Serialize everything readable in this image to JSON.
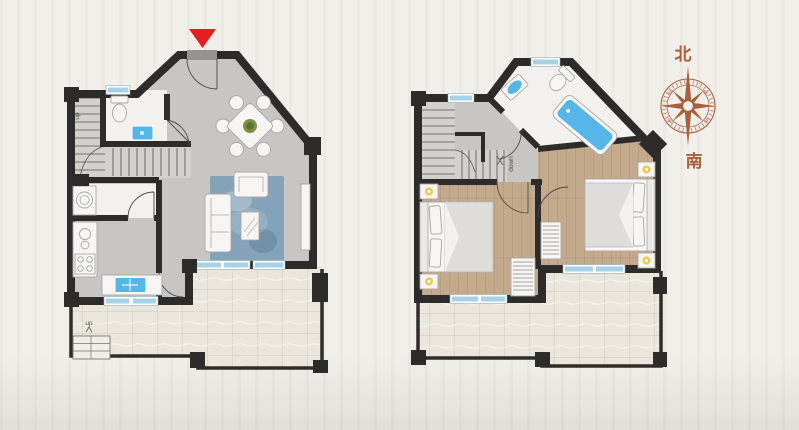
{
  "scene": {
    "description": "Two-storey home floor plans: ground floor (left) with entrance, bathroom, kitchen, living-dining room and terrace; upper floor (right) with bathroom, two bedrooms and terrace; compass rose at right",
    "background_color": "#f2eeea"
  },
  "colors": {
    "scene-bg": "#f2eeea",
    "wall": "#2e2c2a",
    "interior-floor": "#c8c6c2",
    "stair-floor": "#d3d1cd",
    "bathroom-floor": "#f3f1ed",
    "terrace-floor": "#eae6dc",
    "terrace-line": "#d9d4c8",
    "wood-floor": "#c3aa8d",
    "wood-line": "#b09576",
    "rug": "#84a3b8",
    "fixture-blue": "#56b6e8",
    "window-glass": "#a6d2e8",
    "window-frame": "#ffffff",
    "furniture-fill": "#f6f5f3",
    "furniture-stroke": "#a9a7a3",
    "duvet": "#dfddd9",
    "accent-red": "#e41e1c",
    "compass": "#a5613d",
    "label-text": "#4a4a48",
    "plant": "#7c8f44",
    "flower-yellow": "#ecc94f",
    "lintel": "#97948f"
  },
  "ground_floor": {
    "stair_label": "up",
    "exterior_stair_label": "up"
  },
  "upper_floor": {
    "stair_label": "down"
  },
  "compass": {
    "north": "北",
    "south": "南",
    "ordinals": [
      "NW",
      "NE",
      "SE",
      "SW"
    ]
  }
}
